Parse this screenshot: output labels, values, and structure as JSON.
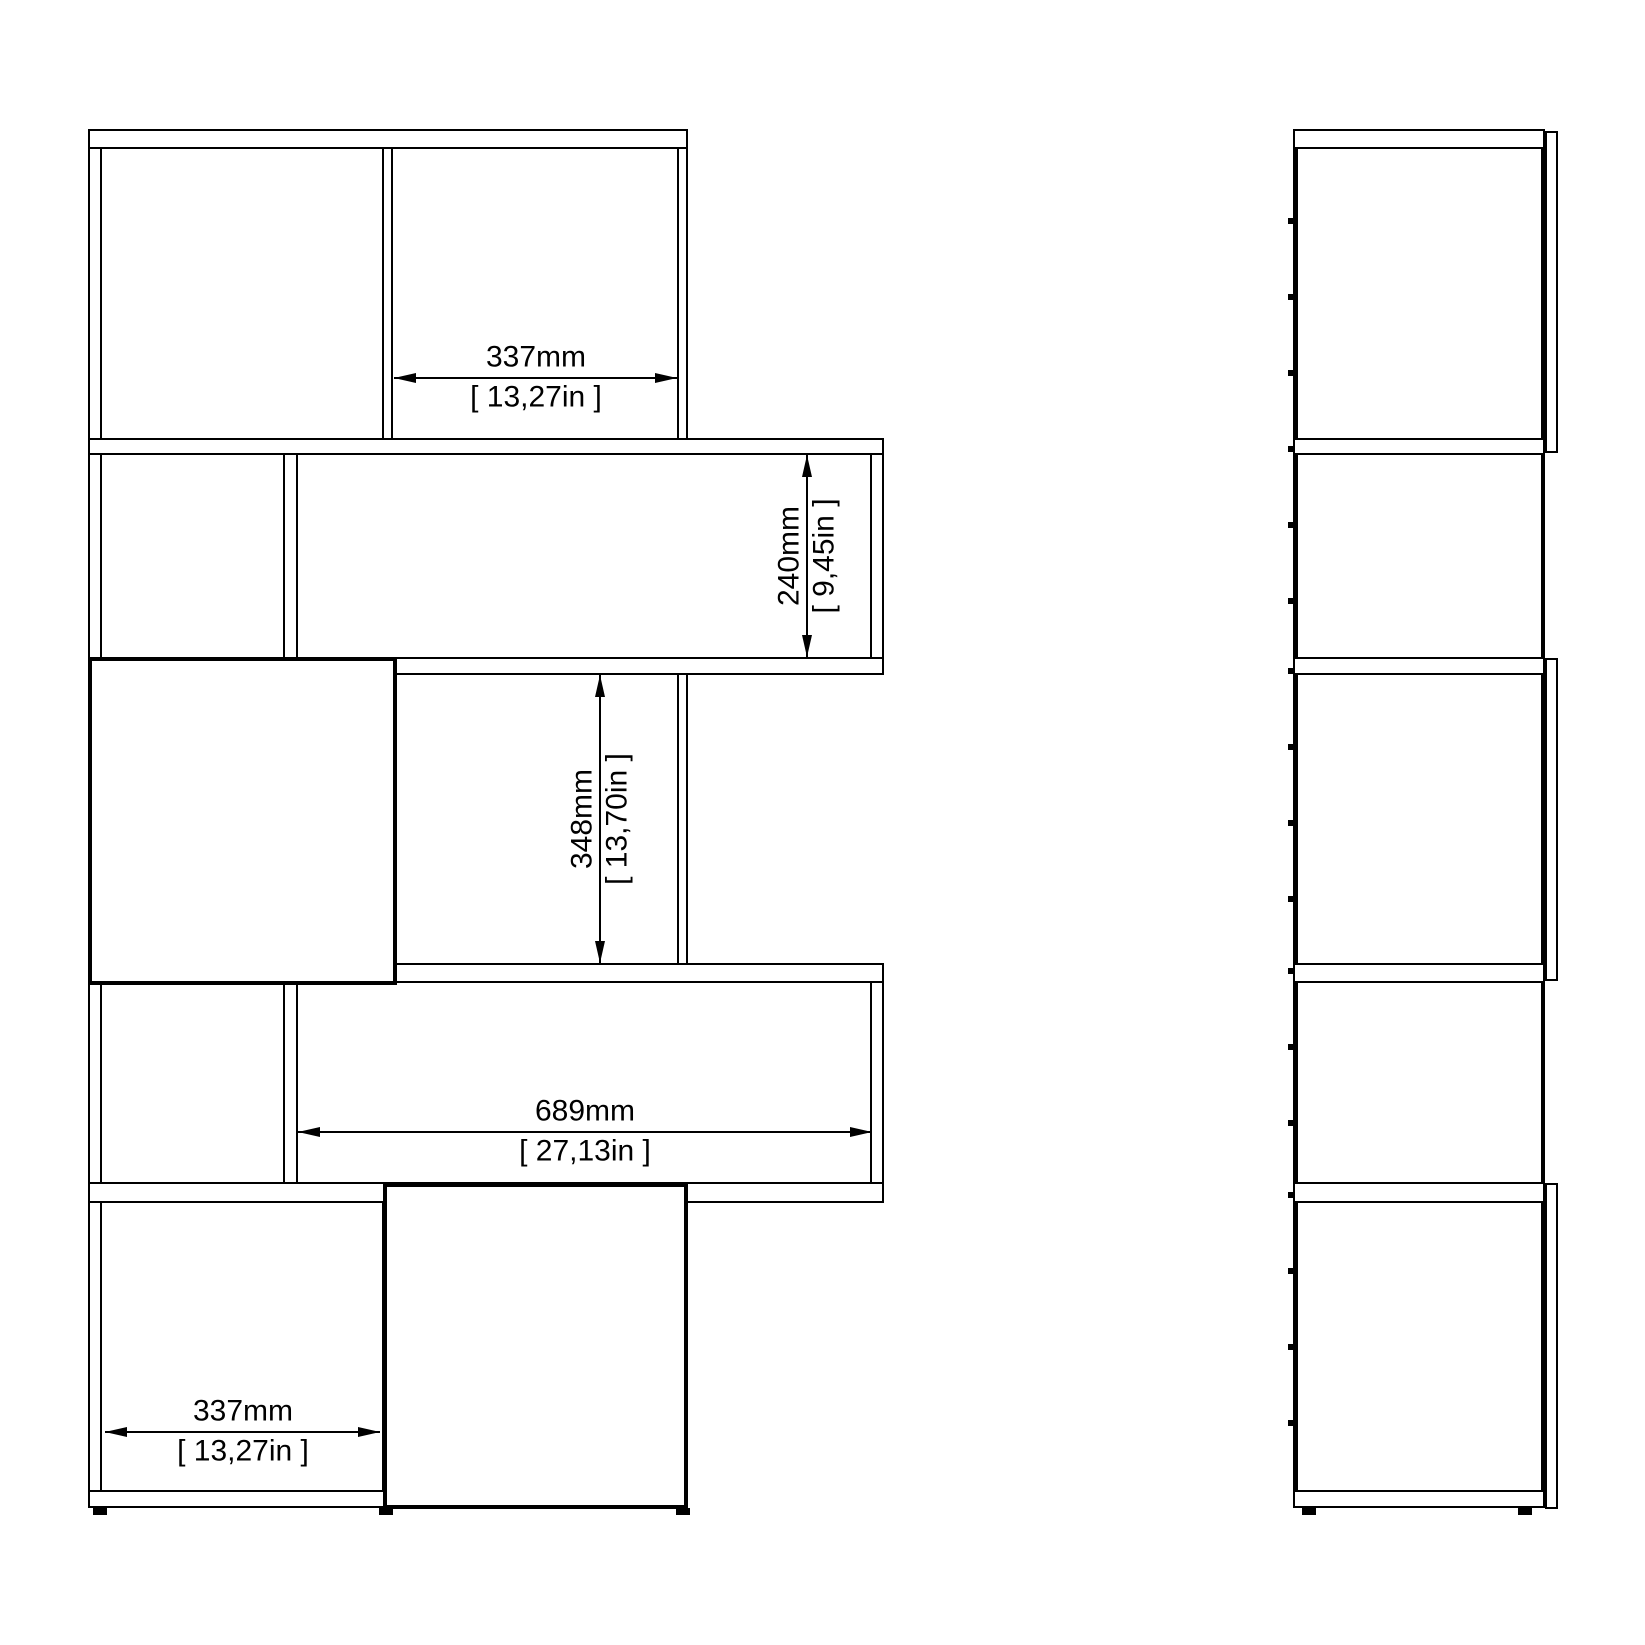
{
  "drawing": {
    "type": "furniture-dimension-diagram",
    "subject": "zigzag bookcase with two doors, front and side elevation views",
    "colors": {
      "line": "#000000",
      "background": "#ffffff"
    },
    "views": {
      "front": {
        "name": "front-elevation"
      },
      "side": {
        "name": "side-elevation"
      }
    },
    "dimensions": {
      "top_compartment_width": {
        "mm": "337mm",
        "in": "[ 13,27in ]"
      },
      "middle_shelf_height": {
        "mm": "240mm",
        "in": "[ 9,45in ]"
      },
      "center_compartment_height": {
        "mm": "348mm",
        "in": "[ 13,70in ]"
      },
      "wide_shelf_width": {
        "mm": "689mm",
        "in": "[ 27,13in ]"
      },
      "bottom_compartment_width": {
        "mm": "337mm",
        "in": "[ 13,27in ]"
      }
    }
  }
}
